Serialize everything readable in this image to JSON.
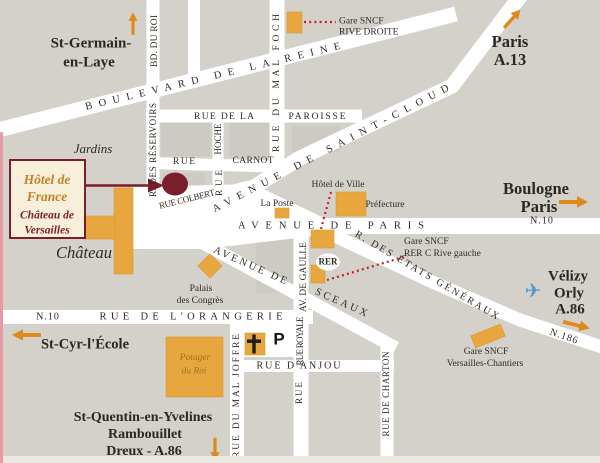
{
  "card": {
    "l1": "Hôtel de",
    "l2": "France",
    "l3": "Château de",
    "l4": "Versailles"
  },
  "streets": {
    "roi": "BD. DU ROI",
    "reservoirs": "R. DES RÉSERVOIRS",
    "reine": "BOULEVARD DE LA REINE",
    "foch": "RUE DU MAL FOCH",
    "paroisse1": "RUE DE LA",
    "paroisse2": "PAROISSE",
    "hoche": "HOCHE",
    "hoche_rue": "RUE",
    "carnot_rue": "RUE",
    "carnot": "CARNOT",
    "colbert": "RUE COLBERT",
    "saint_cloud": "AVENUE DE SAINT-CLOUD",
    "av_paris": "AVENUE DE PARIS",
    "sceaux1": "AVENUE DE",
    "sceaux2": "SCEAUX",
    "gaulle": "AV. DE GAULLE",
    "royale": "RUE ROYALE",
    "royale_rue": "RUE",
    "etats": "R. DES ÉTATS GÉNÉRAUX",
    "orangerie": "RUE DE L'ORANGERIE",
    "anjou": "RUE D'ANJOU",
    "joffre": "RUE DU MAL JOFFRE",
    "charton": "RUE DE CHARTON",
    "n10_east": "N.10",
    "n10_west": "N.10",
    "n186": "N.186"
  },
  "places": {
    "jardins": "Jardins",
    "chateau": "Château",
    "palais1": "Palais",
    "palais2": "des Congrès",
    "poste": "La Poste",
    "hdv": "Hôtel de Ville",
    "prefecture": "Préfecture",
    "rer": "RER",
    "potager1": "Potager",
    "potager2": "du Roi",
    "parking": "P",
    "gare_rd1": "Gare SNCF",
    "gare_rd2": "RIVE DROITE",
    "gare_rer1": "Gare SNCF",
    "gare_rer2": "RER C Rive gauche",
    "gare_vc1": "Gare SNCF",
    "gare_vc2": "Versailles-Chantiers"
  },
  "destinations": {
    "stgermain1": "St-Germain-",
    "stgermain2": "en-Laye",
    "paris1": "Paris",
    "paris2": "A.13",
    "boulogne1": "Boulogne",
    "boulogne2": "Paris",
    "velizy1": "Vélizy",
    "velizy2": "Orly",
    "velizy3": "A.86",
    "stcyr": "St-Cyr-l'École",
    "sw1": "St-Quentin-en-Yvelines",
    "sw2": "Rambouillet",
    "sw3": "Dreux - A.86"
  },
  "icons": {
    "plane": "✈"
  },
  "colors": {
    "background": "#d4d0ca",
    "street_white": "#ffffff",
    "building_gold": "#e8a73e",
    "hotel_maroon": "#7b1e2b",
    "route_orange": "#e0891b",
    "link_red": "#cc2027",
    "plane_blue": "#5597cd",
    "card_cream": "#f8efda"
  }
}
